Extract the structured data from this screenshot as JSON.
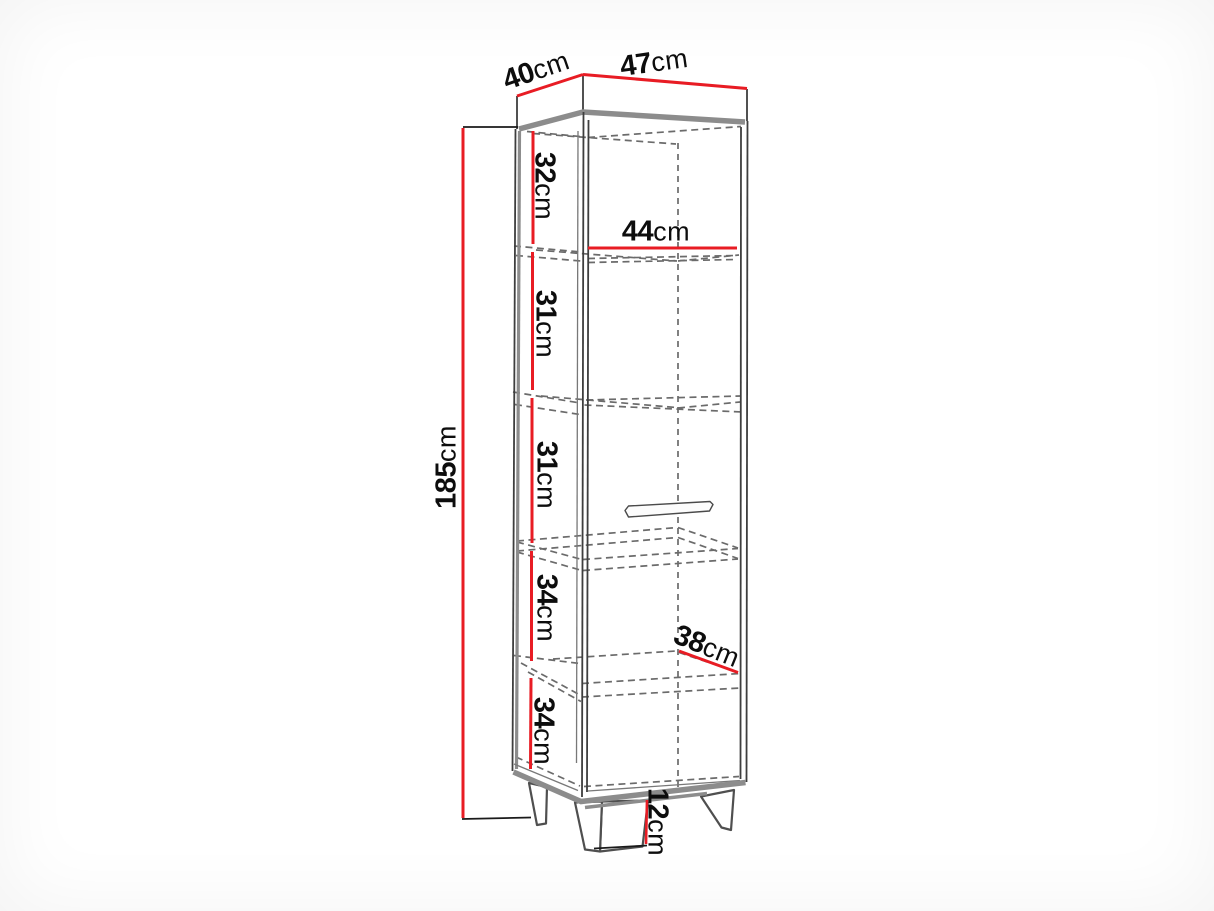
{
  "diagram": {
    "name": "Corner display cabinet dimension drawing"
  },
  "colors": {
    "dimension": "#e81c24",
    "outline": "#3e3e3e",
    "panel": "#8c8c8c",
    "dashed": "#6b6b6b",
    "label": "#0d0d0d",
    "background": "#ffffff"
  },
  "dimensions": {
    "top_side_width": {
      "value": "40",
      "unit": "cm"
    },
    "top_front_width": {
      "value": "47",
      "unit": "cm"
    },
    "total_height": {
      "value": "185",
      "unit": "cm"
    },
    "section_top": {
      "value": "32",
      "unit": "cm"
    },
    "inner_width": {
      "value": "44",
      "unit": "cm"
    },
    "section_second": {
      "value": "31",
      "unit": "cm"
    },
    "section_third": {
      "value": "31",
      "unit": "cm"
    },
    "section_fourth": {
      "value": "34",
      "unit": "cm"
    },
    "inner_depth": {
      "value": "38",
      "unit": "cm"
    },
    "section_bottom": {
      "value": "34",
      "unit": "cm"
    },
    "leg_height": {
      "value": "12",
      "unit": "cm"
    }
  }
}
